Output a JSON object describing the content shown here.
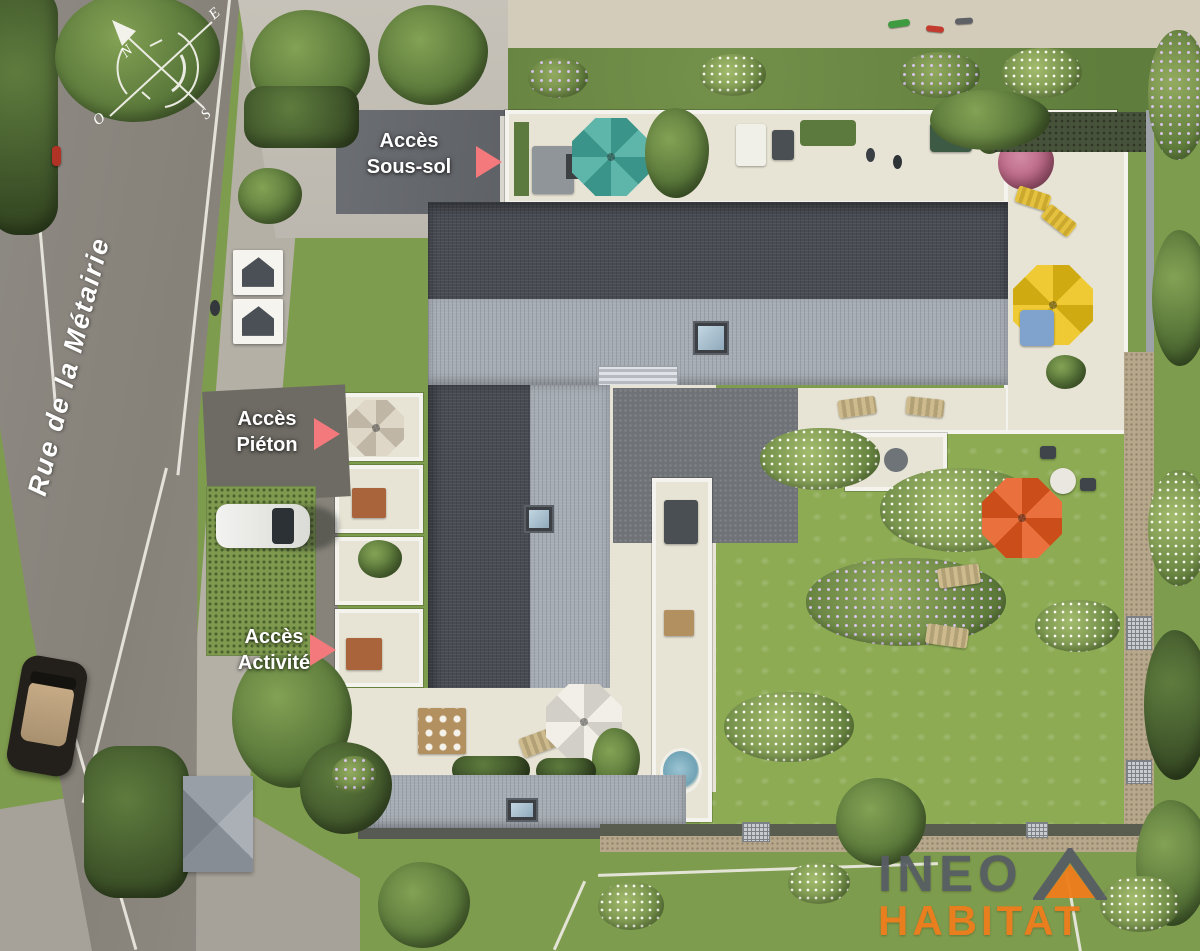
{
  "labels": {
    "basement": {
      "line1": "Accès",
      "line2": "Sous-sol"
    },
    "pedestrian": {
      "line1": "Accès",
      "line2": "Piéton"
    },
    "activity": {
      "line1": "Accès",
      "line2": "Activité"
    }
  },
  "street": {
    "name": "Rue de la Métairie"
  },
  "compass": {
    "north": "N",
    "east": "E",
    "south": "S",
    "west": "O"
  },
  "logo": {
    "line1": "INEO",
    "line2": "HABITAT"
  },
  "colors": {
    "access_arrow": "#f4797c",
    "logo_primary": "#585d64",
    "logo_accent": "#ee7d1b",
    "umbrella_rooftop_teal": "#43a99c",
    "umbrella_terrace_yellow": "#ecc113",
    "umbrella_garden_orange": "#e7591d",
    "umbrella_courtyard_white": "#efece3",
    "umbrella_terrace_tan": "#d9cfbd",
    "roof_dark": "#474b52",
    "roof_light": "#a6acb4",
    "lawn_green": "#8cab53",
    "terrace_beige": "#e8e4d5"
  },
  "icons": {
    "compass": "compass-rose",
    "access_arrow": "triangle-right-arrow",
    "entrance_sign": "house-pictogram"
  }
}
